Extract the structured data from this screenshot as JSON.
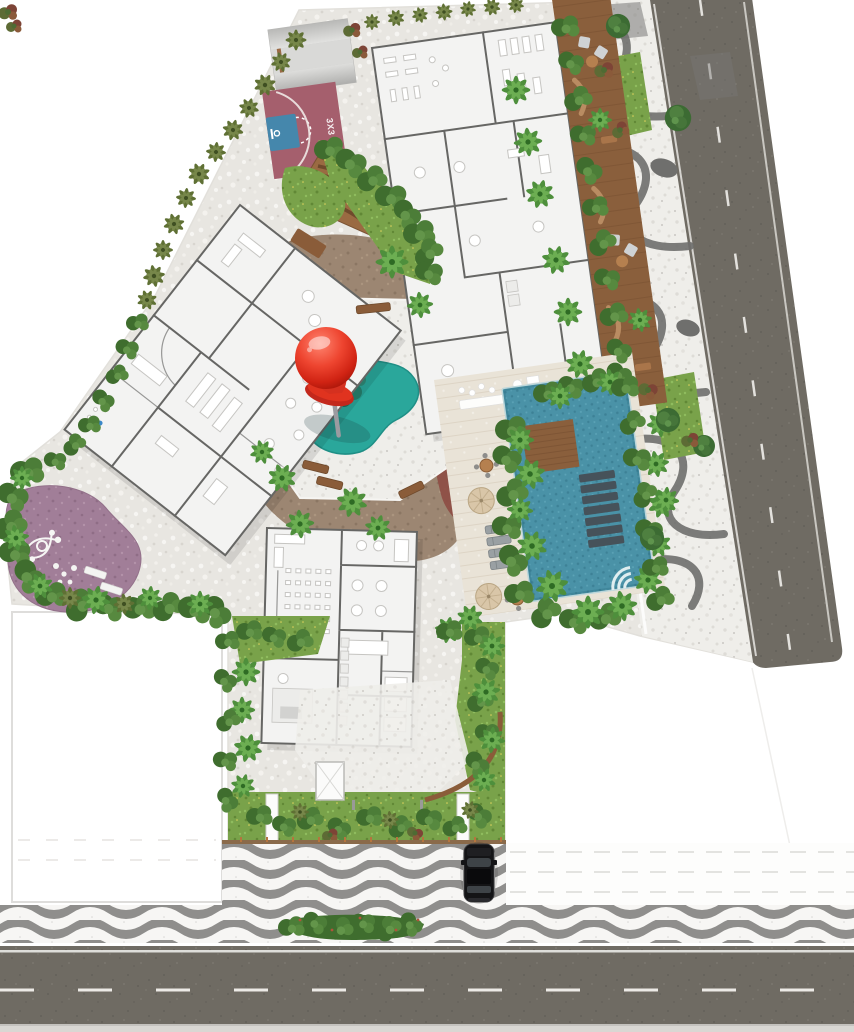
{
  "title": "Residential condominium implantation site plan",
  "plan_type": "architectural masterplan, top view",
  "labels": {
    "basketball_court": "3X3"
  },
  "marker": {
    "kind": "red-pushpin",
    "color": "#e02b1d"
  },
  "features": [
    "skate-ramp",
    "basketball-court-3x3",
    "amphitheater-wood-deck",
    "building-a-floorplan",
    "building-b-floorplan",
    "building-c-floorplan",
    "kids-splash-pad",
    "red-pushpin-marker",
    "playground",
    "swimming-pool",
    "in-pool-loungers",
    "pool-wood-bridge",
    "pool-deck-umbrellas",
    "wood-lounge-deck",
    "burle-marx-promenade",
    "promenade-stairs",
    "avenue-road",
    "street-road",
    "copacabana-wave-sidewalk",
    "entrance-gate-pillars",
    "gatehouse",
    "parked-car",
    "palm-trees",
    "hedges",
    "neighbor-parcels"
  ],
  "palette": {
    "site": "#e8e6e1",
    "floor": "#f3f3f2",
    "wall": "#666664",
    "asphalt": "#6f6b63",
    "roadline": "#efeeea",
    "wave": "#8f8e8c",
    "wood": "#8a5c39",
    "deckwood": "#8a5f3c",
    "trav": "#e9e3d7",
    "grass": "#79a24a",
    "hedge": "#3f6d2e",
    "dirt": "#9c8672",
    "mulch": "#8e4c44",
    "play": "#a17e98",
    "court": "#a55f6d",
    "courtkey": "#4587ac",
    "pool": "#4a92a7",
    "splash": "#2aa79b",
    "pin": "#e02b1d"
  }
}
